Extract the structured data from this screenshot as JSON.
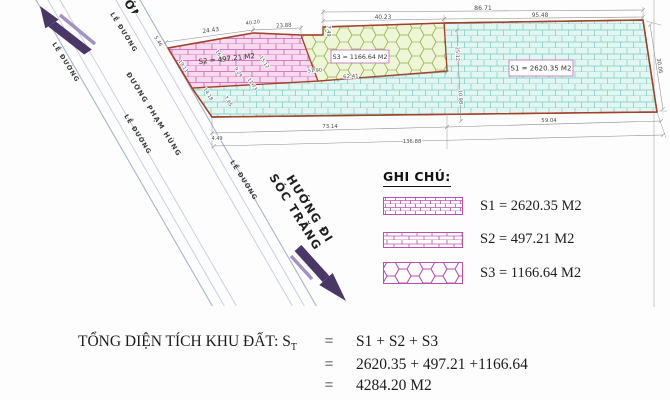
{
  "drawing": {
    "plot_labels": {
      "s1": "S1 = 2620.35 M2",
      "s2": "S2 = 497.21 M2",
      "s3": "S3 = 1166.64 M2"
    },
    "road": {
      "name": "ĐƯỜNG PHẠM HÙNG",
      "edge_label": "LỀ ĐƯỜNG",
      "direction_se_line1": "HƯỚNG ĐI",
      "direction_se_line2": "SÓC TRĂNG",
      "direction_nw_partial": "HƯỚNG ĐI"
    },
    "dimensions": [
      {
        "v": "86.71",
        "x": 483,
        "y": 10,
        "r": 0,
        "s": 6.2
      },
      {
        "v": "40.23",
        "x": 383,
        "y": 19,
        "r": 0,
        "s": 5.8
      },
      {
        "v": "95.48",
        "x": 540,
        "y": 17,
        "r": 0,
        "s": 5.8
      },
      {
        "v": "24.43",
        "x": 211,
        "y": 32,
        "r": -8,
        "s": 5.8
      },
      {
        "v": "40.20",
        "x": 253,
        "y": 24,
        "r": -8,
        "s": 5
      },
      {
        "v": "23.88",
        "x": 284,
        "y": 27,
        "r": -4,
        "s": 5.4
      },
      {
        "v": "5.46",
        "x": 157,
        "y": 42,
        "r": 58,
        "s": 5
      },
      {
        "v": "7.49",
        "x": 327,
        "y": 31,
        "r": 90,
        "s": 5
      },
      {
        "v": "30.06",
        "x": 658,
        "y": 66,
        "r": 81,
        "s": 5.4
      },
      {
        "v": "73.14",
        "x": 330,
        "y": 128,
        "r": 0,
        "s": 5.4
      },
      {
        "v": "59.04",
        "x": 549,
        "y": 122,
        "r": 0,
        "s": 5.4
      },
      {
        "v": "4.49",
        "x": 217,
        "y": 140,
        "r": 0,
        "s": 5
      },
      {
        "v": "136.88",
        "x": 412,
        "y": 143,
        "r": 0,
        "s": 5.4
      },
      {
        "v": "62.41",
        "x": 351,
        "y": 78,
        "r": -4,
        "s": 5.4
      },
      {
        "v": "51.90",
        "x": 315,
        "y": 72,
        "r": -4,
        "s": 5
      },
      {
        "v": "7.65",
        "x": 227,
        "y": 102,
        "r": 58,
        "s": 5
      },
      {
        "v": "25.12",
        "x": 456,
        "y": 54,
        "r": 87,
        "s": 5
      },
      {
        "v": "10.98",
        "x": 459,
        "y": 97,
        "r": 87,
        "s": 5
      },
      {
        "v": "19.11",
        "x": 182,
        "y": 67,
        "r": 58,
        "s": 4.8
      },
      {
        "v": "16.30",
        "x": 219,
        "y": 57,
        "r": 58,
        "s": 4.8
      },
      {
        "v": "9.29",
        "x": 237,
        "y": 73,
        "r": 58,
        "s": 4.8
      },
      {
        "v": "15.12",
        "x": 263,
        "y": 63,
        "r": 58,
        "s": 4.8
      },
      {
        "v": "11.73",
        "x": 251,
        "y": 85,
        "r": 58,
        "s": 4.8
      },
      {
        "v": "14.18",
        "x": 207,
        "y": 95,
        "r": 58,
        "s": 4.8
      }
    ],
    "dim_lines": [
      [
        323,
        12,
        643,
        10
      ],
      [
        323,
        21,
        444,
        19
      ],
      [
        444,
        19,
        643,
        17
      ],
      [
        166,
        42,
        253,
        30
      ],
      [
        253,
        30,
        301,
        28
      ],
      [
        650,
        25,
        663,
        109
      ],
      [
        212,
        133,
        447,
        127
      ],
      [
        447,
        127,
        661,
        121
      ],
      [
        214,
        146,
        663,
        135
      ],
      [
        457,
        30,
        461,
        121
      ],
      [
        339,
        80,
        447,
        72
      ]
    ],
    "ext_lines": [
      [
        323,
        36,
        323,
        9
      ],
      [
        444,
        23,
        444,
        15
      ],
      [
        643,
        20,
        643,
        7
      ],
      [
        168,
        48,
        163,
        39
      ],
      [
        253,
        34,
        253,
        26
      ],
      [
        301,
        36,
        301,
        25
      ],
      [
        212,
        118,
        212,
        149
      ],
      [
        447,
        114,
        447,
        149
      ],
      [
        657,
        112,
        666,
        138
      ],
      [
        646,
        21,
        661,
        25
      ],
      [
        659,
        111,
        667,
        111
      ]
    ]
  },
  "legend": {
    "title": "GHI CHÚ:",
    "items": [
      {
        "pattern": "grid",
        "label": "S1 = 2620.35 M2"
      },
      {
        "pattern": "brick",
        "label": "S2 = 497.21 M2"
      },
      {
        "pattern": "hex",
        "label": "S3 = 1166.64 M2"
      }
    ]
  },
  "summary": {
    "label": "TỔNG DIỆN TÍCH KHU ĐẤT: S",
    "label_sub": "T",
    "eq": "=",
    "line1": "S1 + S2 + S3",
    "line2": "2620.35 + 497.21 +1166.64",
    "line3": "4284.20 M2"
  },
  "colors": {
    "boundary": "#a2402a",
    "s1_fill": "#e4f6f2",
    "s1_line": "#74ccc3",
    "s2_fill": "#f8daef",
    "s2_line": "#ca5cb4",
    "s3_fill": "#eff6d8",
    "s3_line": "#9cb95e",
    "legend_pattern": "#b94fb0",
    "arrow_dark": "#4a3768",
    "arrow_light": "#a393c4",
    "road_line": "#b3bdd2"
  }
}
